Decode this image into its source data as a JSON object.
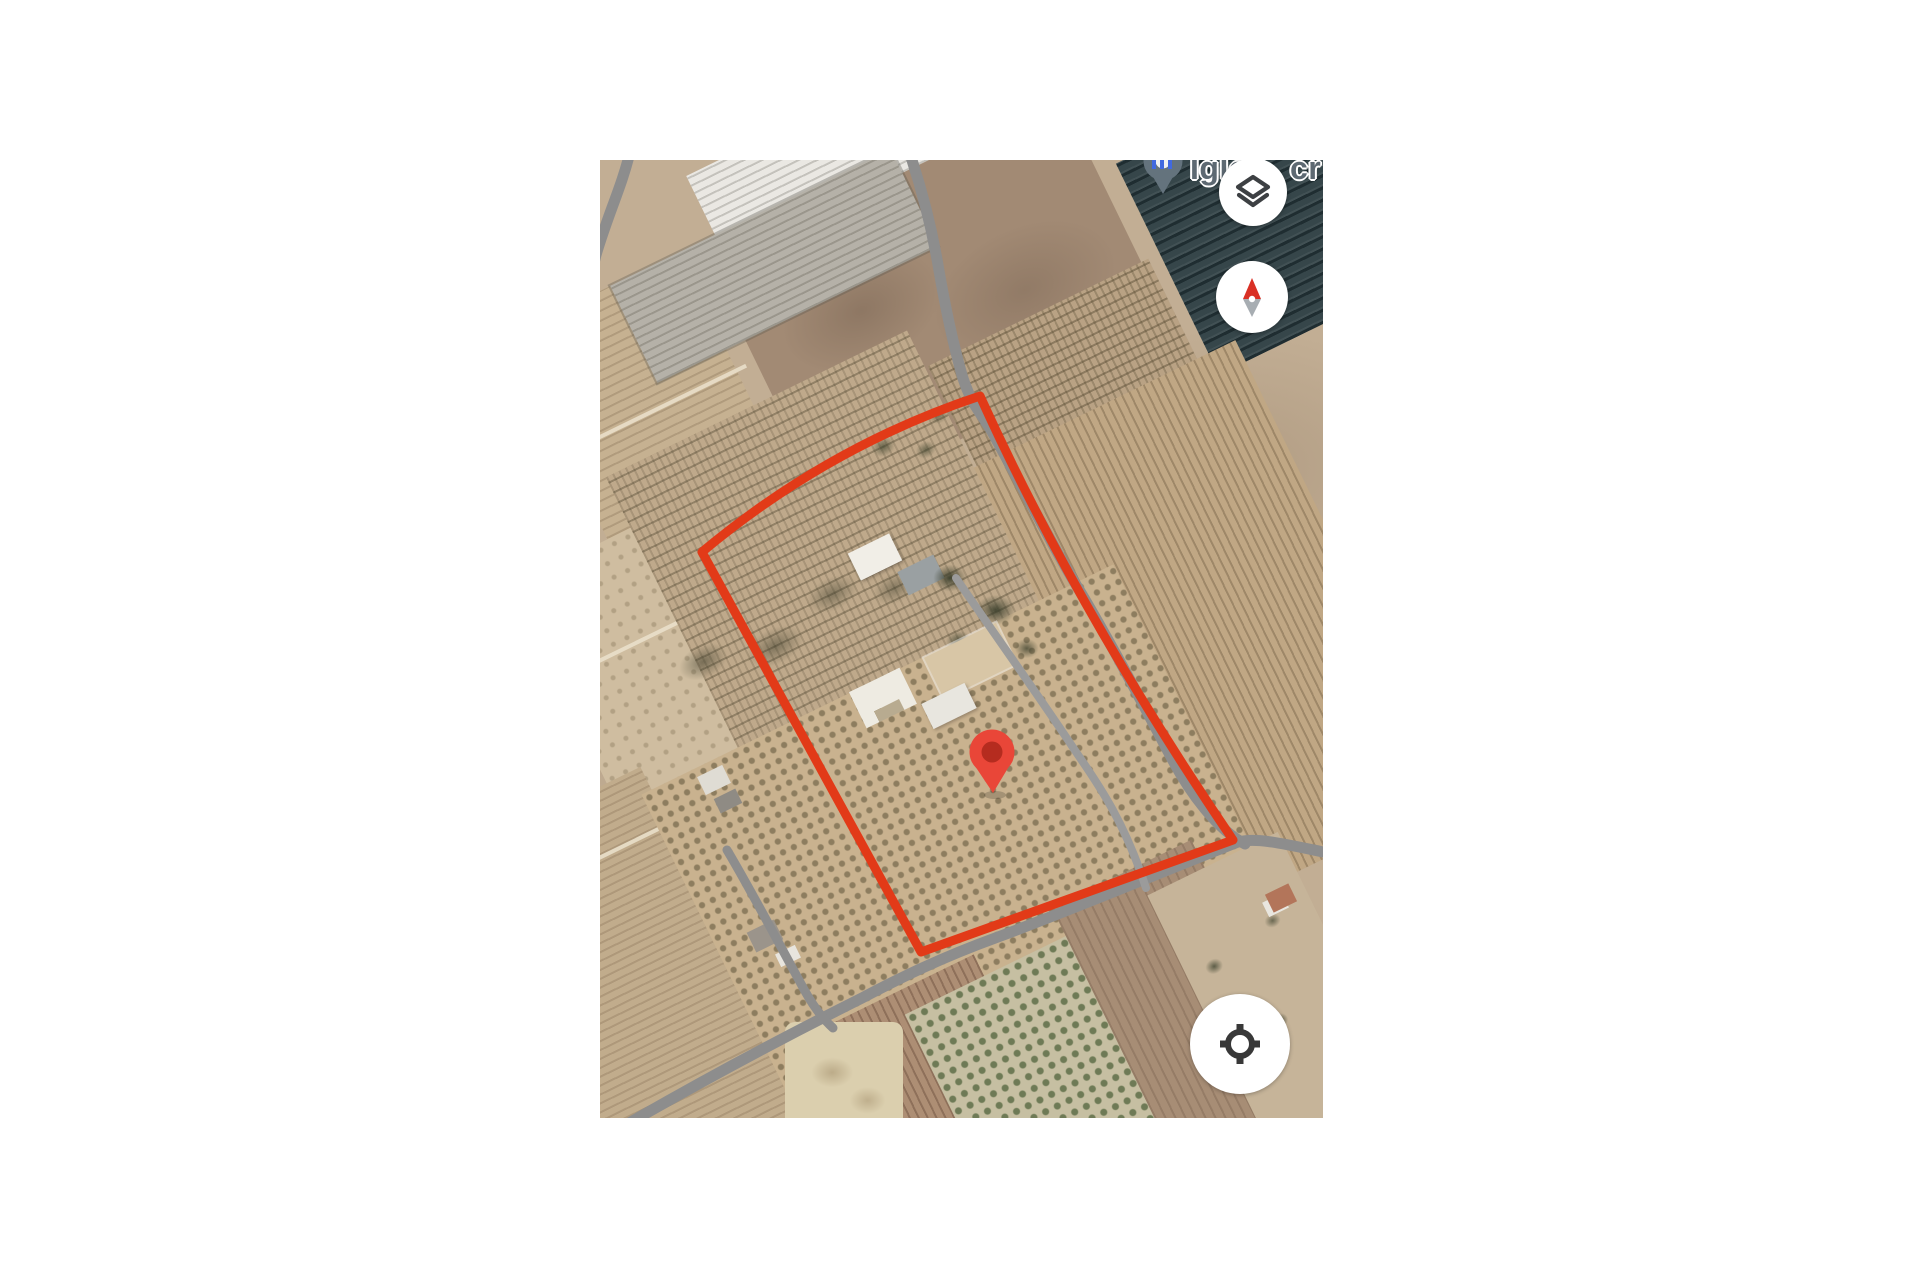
{
  "map": {
    "poi_label": {
      "fragment_left": "Igle",
      "fragment_right": "cr"
    },
    "poi_pin": {
      "transform": "translate(563,4)"
    },
    "marker": {
      "transform": "translate(392,595)"
    },
    "overlay": {
      "boundary_path": "M380,236 Q229,286 102,392 L321,792 L633,680 Q478,452 380,236 Z"
    },
    "roads": {
      "left_curve": "M30,-8 C22,26 8,54 -4,95 C-10,118 -13,142 -12,168",
      "main": "M310,-6 C322,30 332,70 338,105 C344,140 352,180 362,215 C370,242 380,252 391,270 C420,322 450,382 478,428 C506,474 544,546 570,595 C590,634 618,670 645,684",
      "bottom": "M733,694 C684,684 657,677 638,682 C556,714 476,748 398,777 C340,798 300,818 262,838 C178,880 100,922 24,966",
      "short": "M127,690 C152,732 178,782 200,822 C212,845 222,858 233,868",
      "track": "M356,418 C386,462 436,532 472,586 C492,616 522,654 546,728"
    },
    "controls": {
      "layers_label": "Layers",
      "compass_label": "Compass",
      "my_location_label": "My location"
    },
    "icons": [
      "layers-icon",
      "compass-needle-icon",
      "my-location-icon",
      "location-pin-icon",
      "poi-pin-icon"
    ],
    "colors": {
      "accent-red": "#e23a18",
      "pin-red": "#e94638",
      "pin-dot": "#b52c1f",
      "road-gray": "#8d8d8d",
      "label-gray": "#5d6972",
      "poi-gray": "#64737d",
      "blue-label": "#4169e0",
      "needle-red": "#d93025",
      "needle-gray": "#a7adb2",
      "icon-dark": "#3d4043"
    }
  }
}
